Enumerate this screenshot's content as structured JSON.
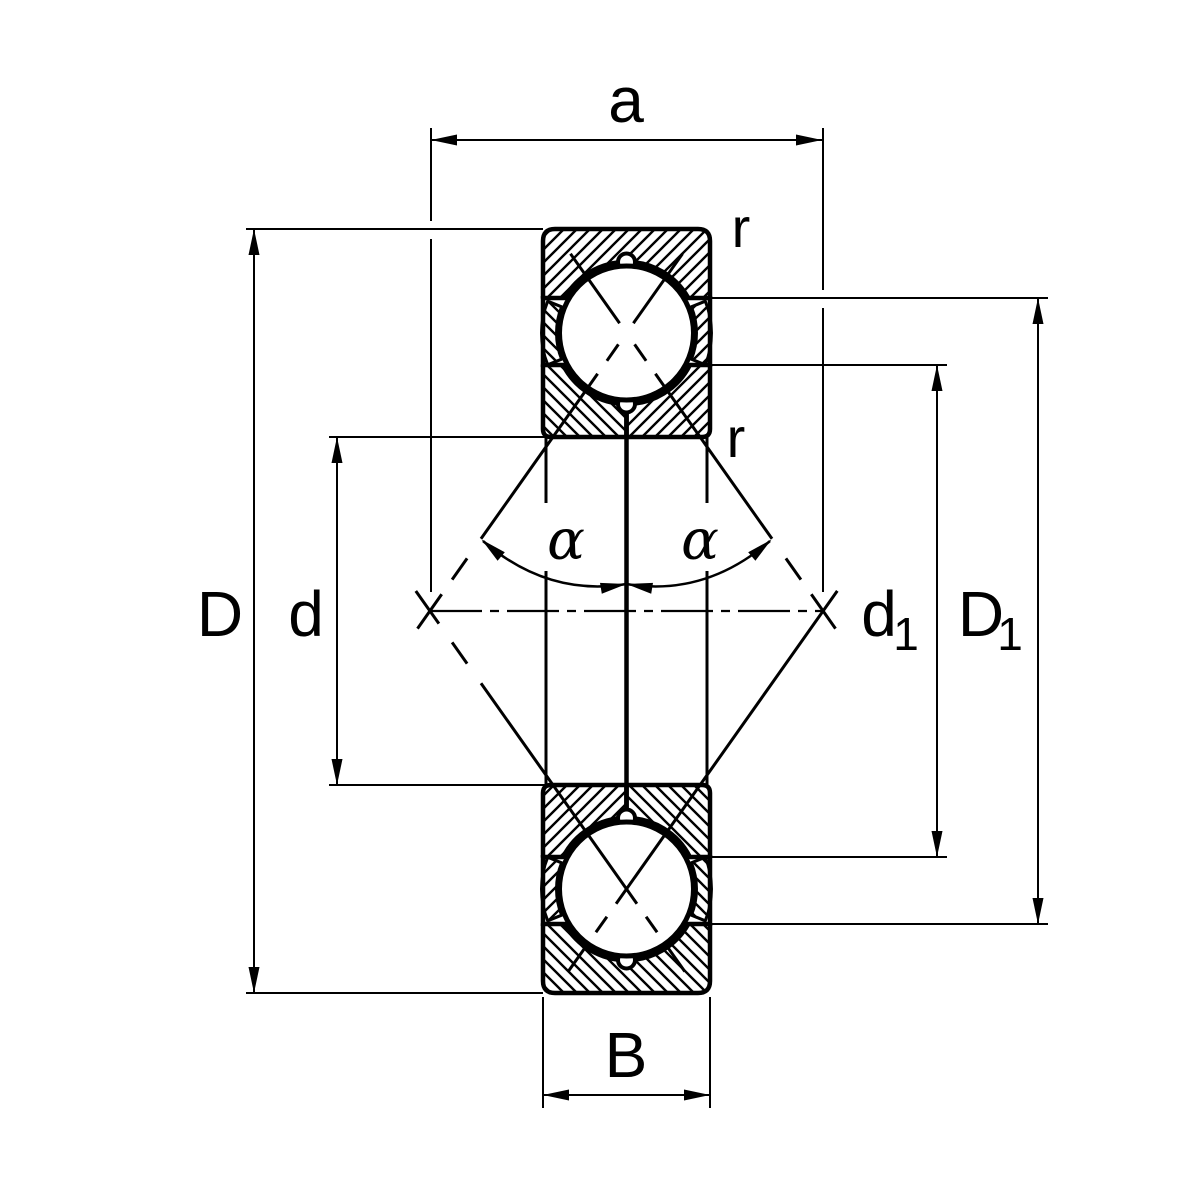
{
  "diagram": {
    "subject": "four-point contact ball bearing cross-section technical drawing",
    "colors": {
      "line": "#000000",
      "background": "#ffffff"
    },
    "dimension_labels": {
      "pressure_center_distance": "a",
      "chamfer_radius_top": "r",
      "chamfer_radius_inner": "r",
      "outer_diameter": "D",
      "bore_diameter": "d",
      "inner_shoulder_diameter": {
        "base": "d",
        "sub": "1"
      },
      "outer_shoulder_diameter": {
        "base": "D",
        "sub": "1"
      },
      "ring_width": "B",
      "contact_angle_left": "α",
      "contact_angle_right": "α"
    }
  }
}
